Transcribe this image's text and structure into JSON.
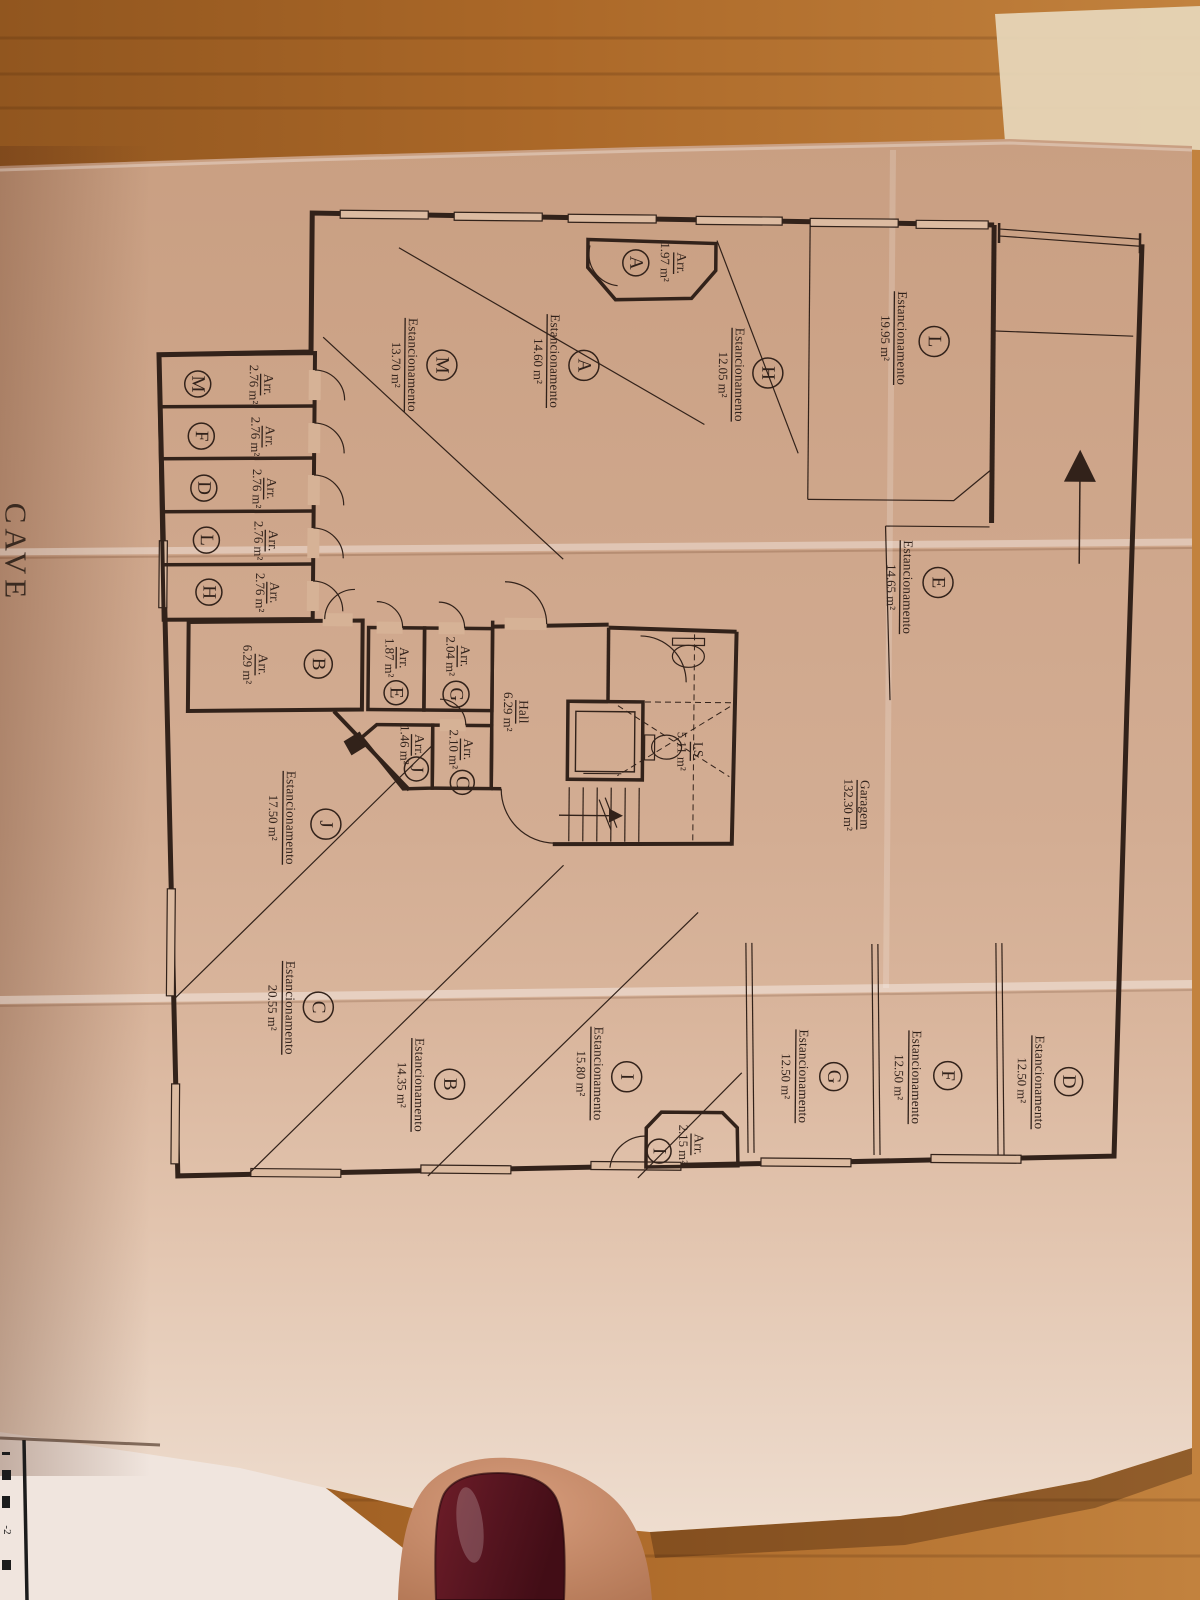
{
  "sheet": {
    "title": "CAVE",
    "underlay_fragment": "-2"
  },
  "plan": {
    "parking_label": "Estancionamento",
    "storage_label": "Arr.",
    "garage": {
      "name": "Garagem",
      "area": "132.30 m²"
    },
    "hall": {
      "name": "Hall",
      "area": "6.29 m²"
    },
    "wc": {
      "name": "I.S.",
      "area": "5.11 m²"
    },
    "parking": [
      {
        "id": "L",
        "area": "19.95 m²"
      },
      {
        "id": "H",
        "area": "12.05 m²"
      },
      {
        "id": "A",
        "area": "14.60 m²"
      },
      {
        "id": "M",
        "area": "13.70 m²"
      },
      {
        "id": "E",
        "area": "14.65 m²"
      },
      {
        "id": "J",
        "area": "17.50 m²"
      },
      {
        "id": "C",
        "area": "20.55 m²"
      },
      {
        "id": "B",
        "area": "14.35 m²"
      },
      {
        "id": "I",
        "area": "15.80 m²"
      },
      {
        "id": "G",
        "area": "12.50 m²"
      },
      {
        "id": "F",
        "area": "12.50 m²"
      },
      {
        "id": "D",
        "area": "12.50 m²"
      }
    ],
    "storage": [
      {
        "id": "A",
        "area": "1.97 m²"
      },
      {
        "id": "M",
        "area": "2.76 m²"
      },
      {
        "id": "F",
        "area": "2.76 m²"
      },
      {
        "id": "D",
        "area": "2.76 m²"
      },
      {
        "id": "L",
        "area": "2.76 m²"
      },
      {
        "id": "H",
        "area": "2.76 m²"
      },
      {
        "id": "B",
        "area": "6.29 m²"
      },
      {
        "id": "E",
        "area": "1.87 m²"
      },
      {
        "id": "G",
        "area": "2.04 m²"
      },
      {
        "id": "J",
        "area": "1.46 m²"
      },
      {
        "id": "C",
        "area": "2.10 m²"
      },
      {
        "id": "I",
        "area": "2.15 m²"
      }
    ],
    "colors": {
      "ink": "#32221a",
      "paper": "#d6b296",
      "wood": "#ab6828",
      "nail": "#571520"
    }
  }
}
